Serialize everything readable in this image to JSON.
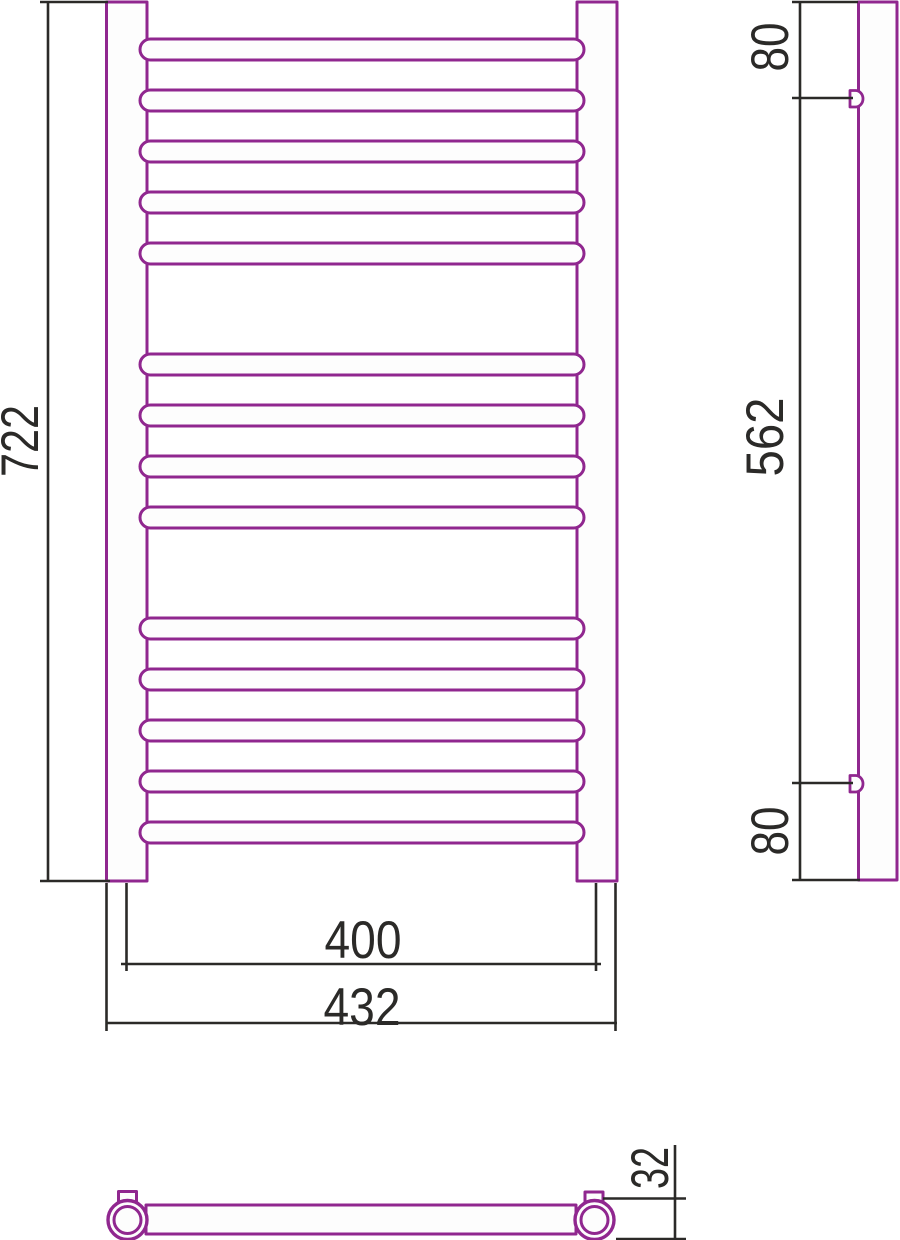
{
  "colors": {
    "product_line": "#90278f",
    "dim_line": "#2b2a28",
    "fill": "#fdfdfd"
  },
  "front_view": {
    "height_label": "722",
    "rail_spacing_label": "400",
    "overall_width_label": "432"
  },
  "side_view": {
    "top_bracket_offset_label": "80",
    "bracket_span_label": "562",
    "bottom_bracket_offset_label": "80"
  },
  "bottom_view": {
    "tube_diameter_label": "32"
  }
}
